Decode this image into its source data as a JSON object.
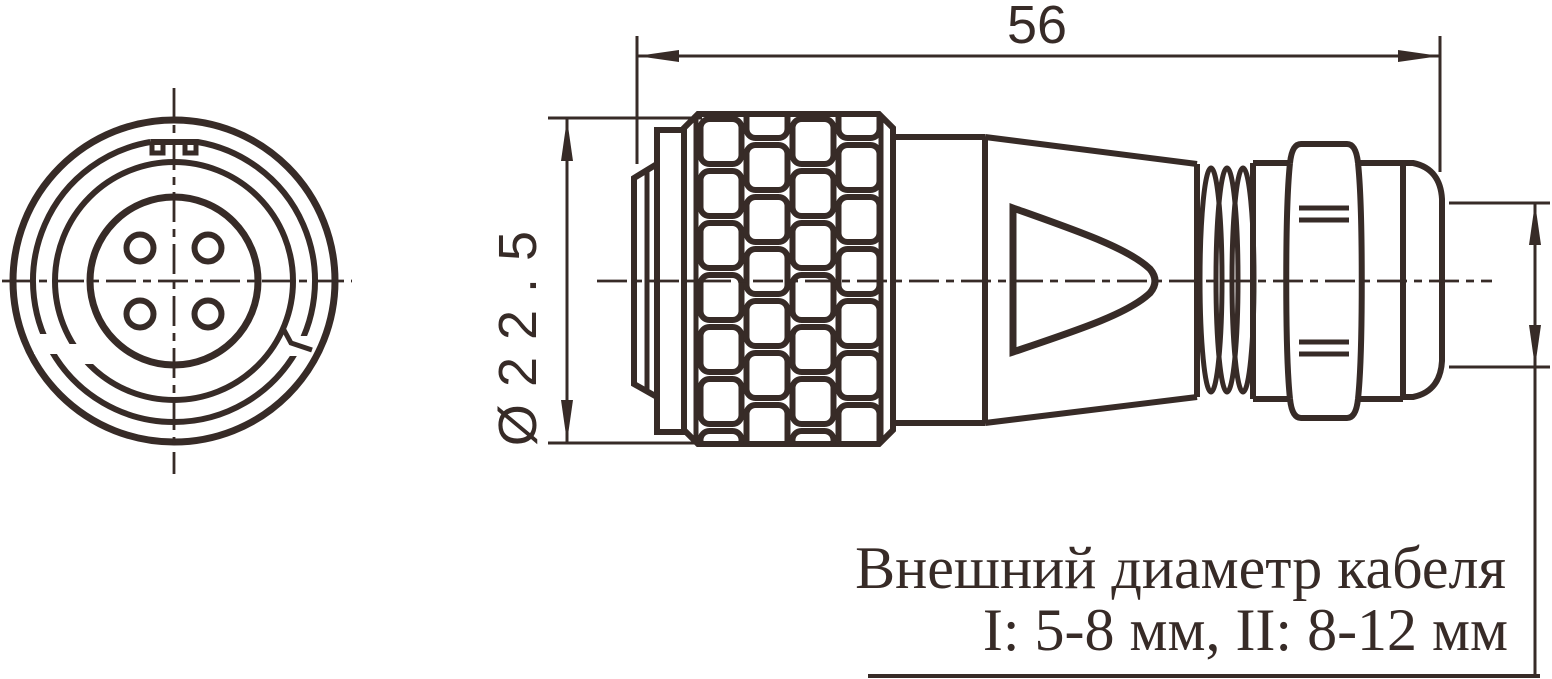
{
  "drawing": {
    "title": "connector-technical-drawing",
    "dimensions": {
      "length_label": "56",
      "diameter_label": "Ø22.5",
      "cable_note_line1": "Внешний диаметр кабеля",
      "cable_note_line2": "I: 5-8 мм, II: 8-12 мм"
    },
    "colors": {
      "line": "#372b27",
      "background": "#ffffff"
    },
    "views": {
      "front_view": "connector face with 4 pin holes",
      "side_view": "connector body with knurled coupling ring, taper, thread and cable gland nut"
    }
  }
}
